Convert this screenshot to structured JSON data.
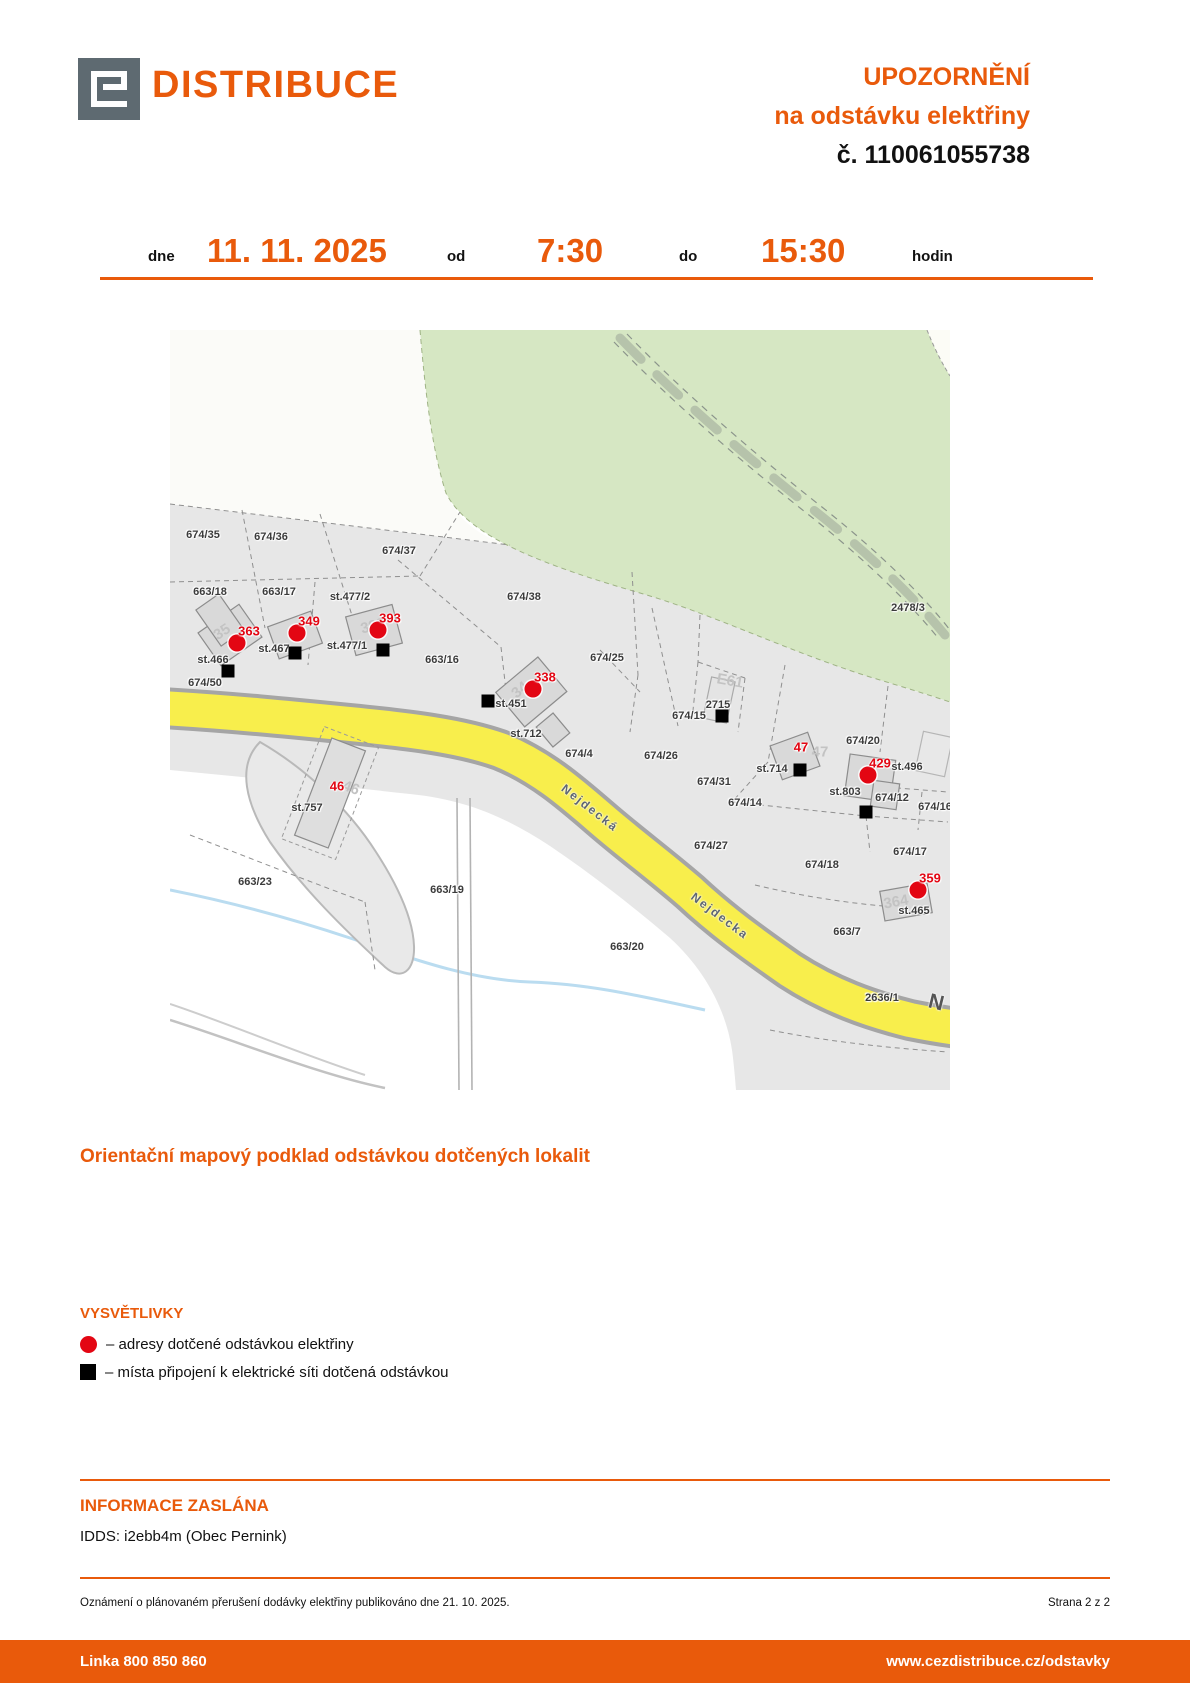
{
  "header": {
    "brand": "DISTRIBUCE",
    "title_line1": "UPOZORNĚNÍ",
    "title_line2": "na odstávku elektřiny",
    "notice_number": "č. 110061055738"
  },
  "schedule": {
    "dne_label": "dne",
    "date": "11. 11. 2025",
    "od_label": "od",
    "from_time": "7:30",
    "do_label": "do",
    "to_time": "15:30",
    "hodin_label": "hodin"
  },
  "map": {
    "parcel_labels": [
      {
        "text": "674/35",
        "x": 33,
        "y": 205
      },
      {
        "text": "674/36",
        "x": 101,
        "y": 207
      },
      {
        "text": "674/37",
        "x": 229,
        "y": 221
      },
      {
        "text": "663/18",
        "x": 40,
        "y": 262
      },
      {
        "text": "663/17",
        "x": 109,
        "y": 262
      },
      {
        "text": "st.477/2",
        "x": 180,
        "y": 267
      },
      {
        "text": "674/38",
        "x": 354,
        "y": 267
      },
      {
        "text": "st.466",
        "x": 43,
        "y": 330
      },
      {
        "text": "st.467",
        "x": 104,
        "y": 319
      },
      {
        "text": "st.477/1",
        "x": 177,
        "y": 316
      },
      {
        "text": "663/16",
        "x": 272,
        "y": 330
      },
      {
        "text": "674/50",
        "x": 35,
        "y": 353
      },
      {
        "text": "674/25",
        "x": 437,
        "y": 328
      },
      {
        "text": "st.451",
        "x": 341,
        "y": 374
      },
      {
        "text": "st.712",
        "x": 356,
        "y": 404
      },
      {
        "text": "674/4",
        "x": 409,
        "y": 424
      },
      {
        "text": "674/26",
        "x": 491,
        "y": 426
      },
      {
        "text": "674/15",
        "x": 519,
        "y": 386
      },
      {
        "text": "2715",
        "x": 548,
        "y": 375
      },
      {
        "text": "2478/3",
        "x": 738,
        "y": 278
      },
      {
        "text": "674/31",
        "x": 544,
        "y": 452
      },
      {
        "text": "674/14",
        "x": 575,
        "y": 473
      },
      {
        "text": "674/27",
        "x": 541,
        "y": 516
      },
      {
        "text": "st.714",
        "x": 602,
        "y": 439
      },
      {
        "text": "674/20",
        "x": 693,
        "y": 411
      },
      {
        "text": "st.803",
        "x": 675,
        "y": 462
      },
      {
        "text": "st.496",
        "x": 737,
        "y": 437
      },
      {
        "text": "674/12",
        "x": 722,
        "y": 468
      },
      {
        "text": "674/16",
        "x": 765,
        "y": 477
      },
      {
        "text": "674/17",
        "x": 740,
        "y": 522
      },
      {
        "text": "674/18",
        "x": 652,
        "y": 535
      },
      {
        "text": "st.465",
        "x": 744,
        "y": 581
      },
      {
        "text": "663/7",
        "x": 677,
        "y": 602
      },
      {
        "text": "663/23",
        "x": 85,
        "y": 552
      },
      {
        "text": "st.757",
        "x": 137,
        "y": 478
      },
      {
        "text": "663/19",
        "x": 277,
        "y": 560
      },
      {
        "text": "663/20",
        "x": 457,
        "y": 617
      },
      {
        "text": "2636/1",
        "x": 712,
        "y": 668
      }
    ],
    "street_labels": [
      {
        "text": "Nejdecká",
        "x": 420,
        "y": 478,
        "rot": 38,
        "big": false
      },
      {
        "text": "Nejdecka",
        "x": 550,
        "y": 586,
        "rot": 37,
        "big": false
      },
      {
        "text": "N",
        "x": 766,
        "y": 673,
        "rot": 14,
        "big": true
      }
    ],
    "ghost_labels": [
      {
        "text": "35",
        "x": 52,
        "y": 302,
        "rot": -33
      },
      {
        "text": "393",
        "x": 203,
        "y": 296,
        "rot": -15
      },
      {
        "text": "34",
        "x": 350,
        "y": 360,
        "rot": -40
      },
      {
        "text": "E61",
        "x": 560,
        "y": 351,
        "rot": 10
      },
      {
        "text": "47",
        "x": 650,
        "y": 422,
        "rot": 0
      },
      {
        "text": "46",
        "x": 181,
        "y": 458,
        "rot": 20
      },
      {
        "text": "364",
        "x": 726,
        "y": 572,
        "rot": -10
      }
    ],
    "address_markers": [
      {
        "number": "363",
        "x": 67,
        "y": 313
      },
      {
        "number": "349",
        "x": 127,
        "y": 303
      },
      {
        "number": "393",
        "x": 208,
        "y": 300
      },
      {
        "number": "338",
        "x": 363,
        "y": 359
      },
      {
        "number": "429",
        "x": 698,
        "y": 445
      },
      {
        "number": "359",
        "x": 748,
        "y": 560
      }
    ],
    "address_texts": [
      {
        "number": "47",
        "x": 631,
        "y": 417
      },
      {
        "number": "46",
        "x": 167,
        "y": 456
      }
    ],
    "connection_points": [
      {
        "x": 58,
        "y": 341
      },
      {
        "x": 125,
        "y": 323
      },
      {
        "x": 213,
        "y": 320
      },
      {
        "x": 318,
        "y": 371
      },
      {
        "x": 552,
        "y": 386
      },
      {
        "x": 630,
        "y": 440
      },
      {
        "x": 696,
        "y": 482
      }
    ]
  },
  "map_caption": "Orientační mapový podklad odstávkou dotčených lokalit",
  "legend": {
    "title": "VYSVĚTLIVKY",
    "items": [
      {
        "symbol": "circle",
        "color": "#e30613",
        "text": "– adresy dotčené odstávkou elektřiny"
      },
      {
        "symbol": "square",
        "color": "#000000",
        "text": "– místa připojení k elektrické síti dotčená odstávkou"
      }
    ]
  },
  "info_sent": {
    "title": "INFORMACE ZASLÁNA",
    "detail": "IDDS: i2ebb4m (Obec Pernink)"
  },
  "footer_note": {
    "left": "Oznámení o plánovaném přerušení dodávky elektřiny publikováno dne 21. 10. 2025.",
    "right": "Strana 2 z 2"
  },
  "footer_bar": {
    "left": "Linka 800 850 860",
    "right": "www.cezdistribuce.cz/odstavky"
  },
  "colors": {
    "orange": "#e95a0b",
    "red": "#e30613",
    "road_yellow": "#f8ee4c",
    "green_area": "#d6e7c3"
  }
}
